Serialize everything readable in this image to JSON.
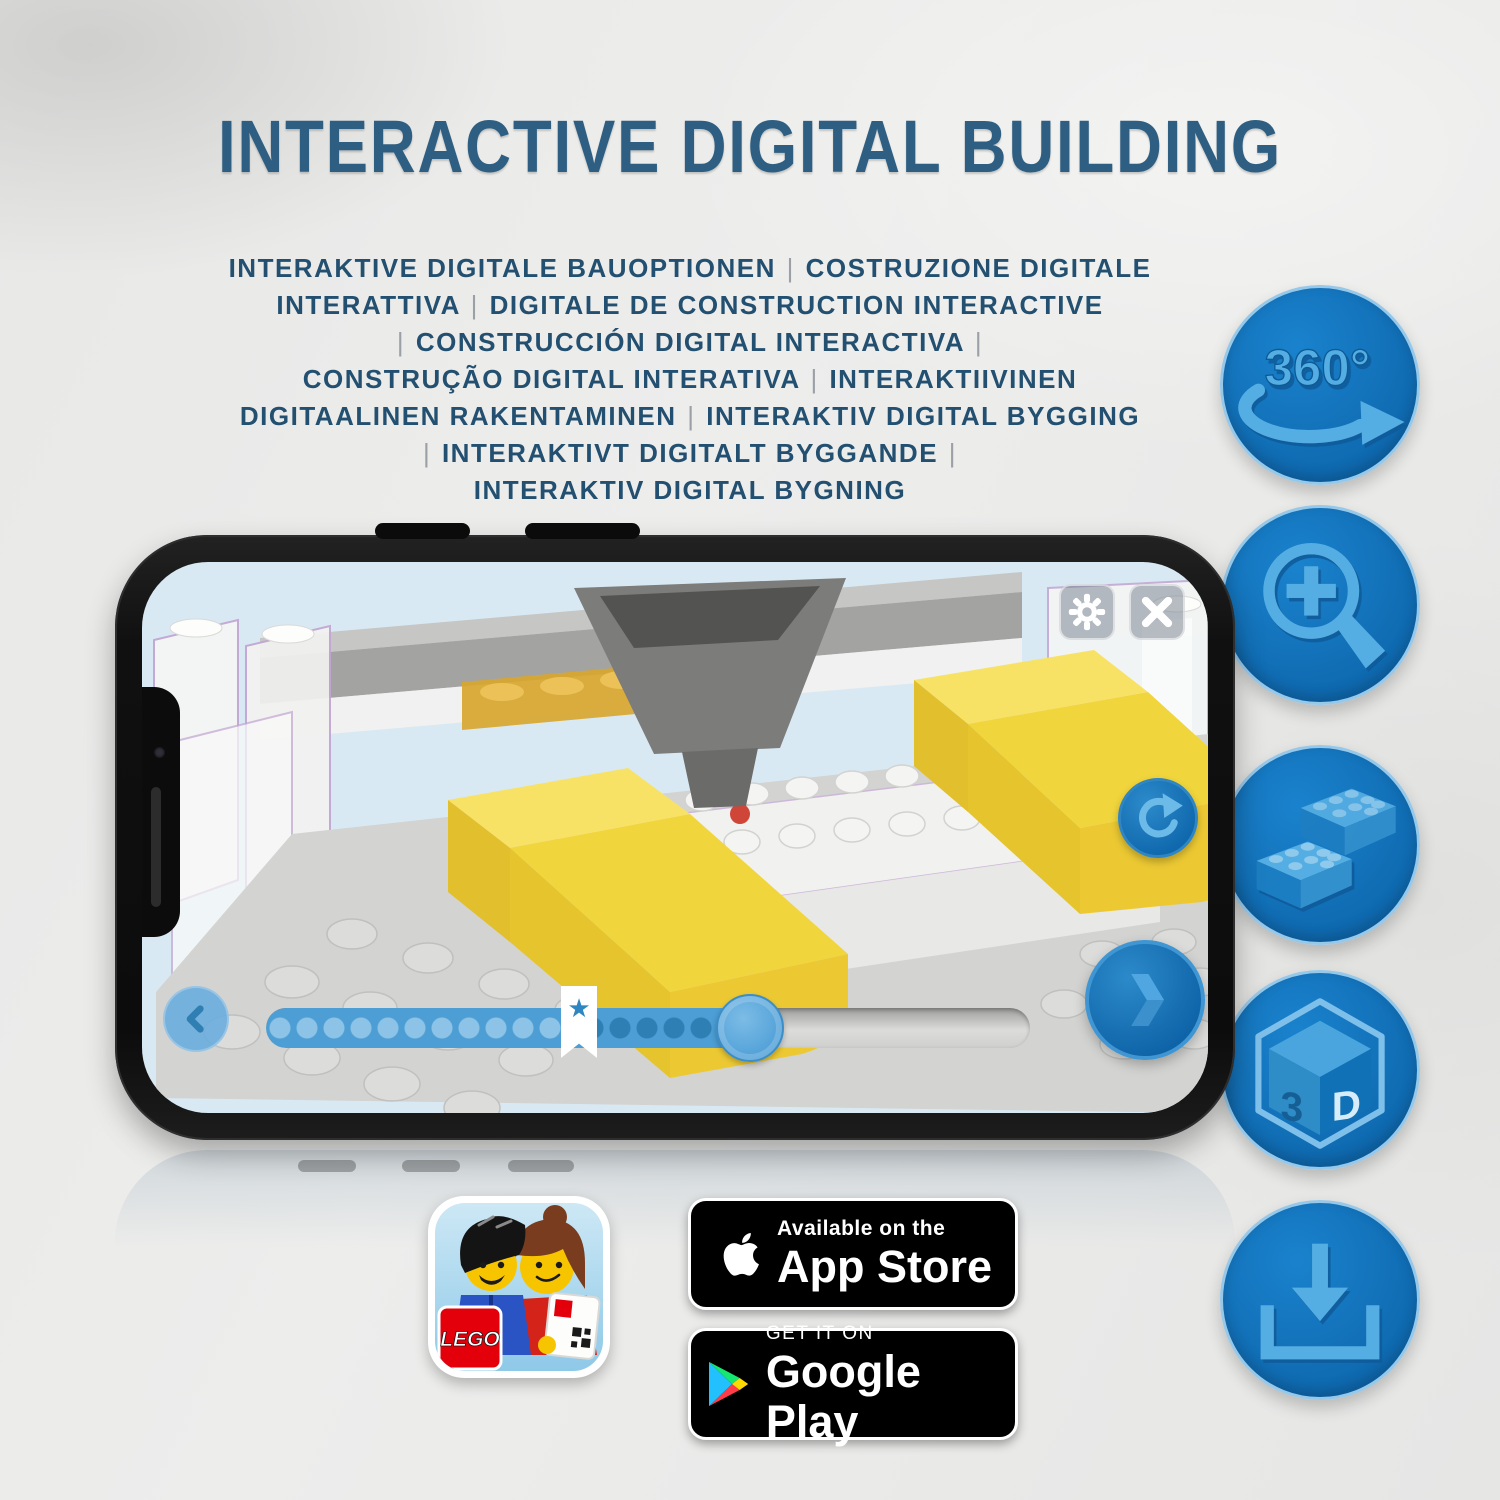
{
  "header": {
    "title": "INTERACTIVE DIGITAL BUILDING",
    "subtitle_lines": [
      "INTERAKTIVE DIGITALE BAUOPTIONEN | COSTRUZIONE DIGITALE",
      "INTERATTIVA | DIGITALE DE CONSTRUCTION INTERACTIVE",
      "| CONSTRUCCIÓN DIGITAL INTERACTIVA |",
      "CONSTRUÇÃO DIGITAL INTERATIVA | INTERAKTIIVINEN",
      "DIGITAALINEN RAKENTAMINEN | INTERAKTIV DIGITAL BYGGING",
      "| INTERAKTIVT DIGITALT BYGGANDE |",
      "INTERAKTIV DIGITAL BYGNING"
    ]
  },
  "feature_badges": {
    "rotate_360_label": "360°",
    "cube_left_label": "3",
    "cube_right_label": "D",
    "icon_names": [
      "360-rotation-icon",
      "zoom-in-icon",
      "lego-brick-icon",
      "3d-cube-icon",
      "download-icon"
    ]
  },
  "phone_app": {
    "slider": {
      "progress_fraction": 0.63,
      "bookmark_star": "★"
    },
    "button_names": [
      "settings-gear",
      "close-x",
      "rotate-reset",
      "previous-step",
      "next-step"
    ]
  },
  "store": {
    "lego_logo_text": "LEGO",
    "app_store_badge": {
      "tagline": "Available on the",
      "name": "App Store"
    },
    "google_play_badge": {
      "tagline": "GET IT ON",
      "name": "Google Play"
    }
  },
  "colors": {
    "title": "#2e5f82",
    "subtitle": "#235070",
    "badge_circle": "#1174bd",
    "badge_glyph": "#55aee3",
    "screen_background": "#d9e9f4",
    "slider_fill": "#4c9ed5",
    "bed_yellow": "#f1d53c",
    "store_badge_background": "#000000"
  }
}
